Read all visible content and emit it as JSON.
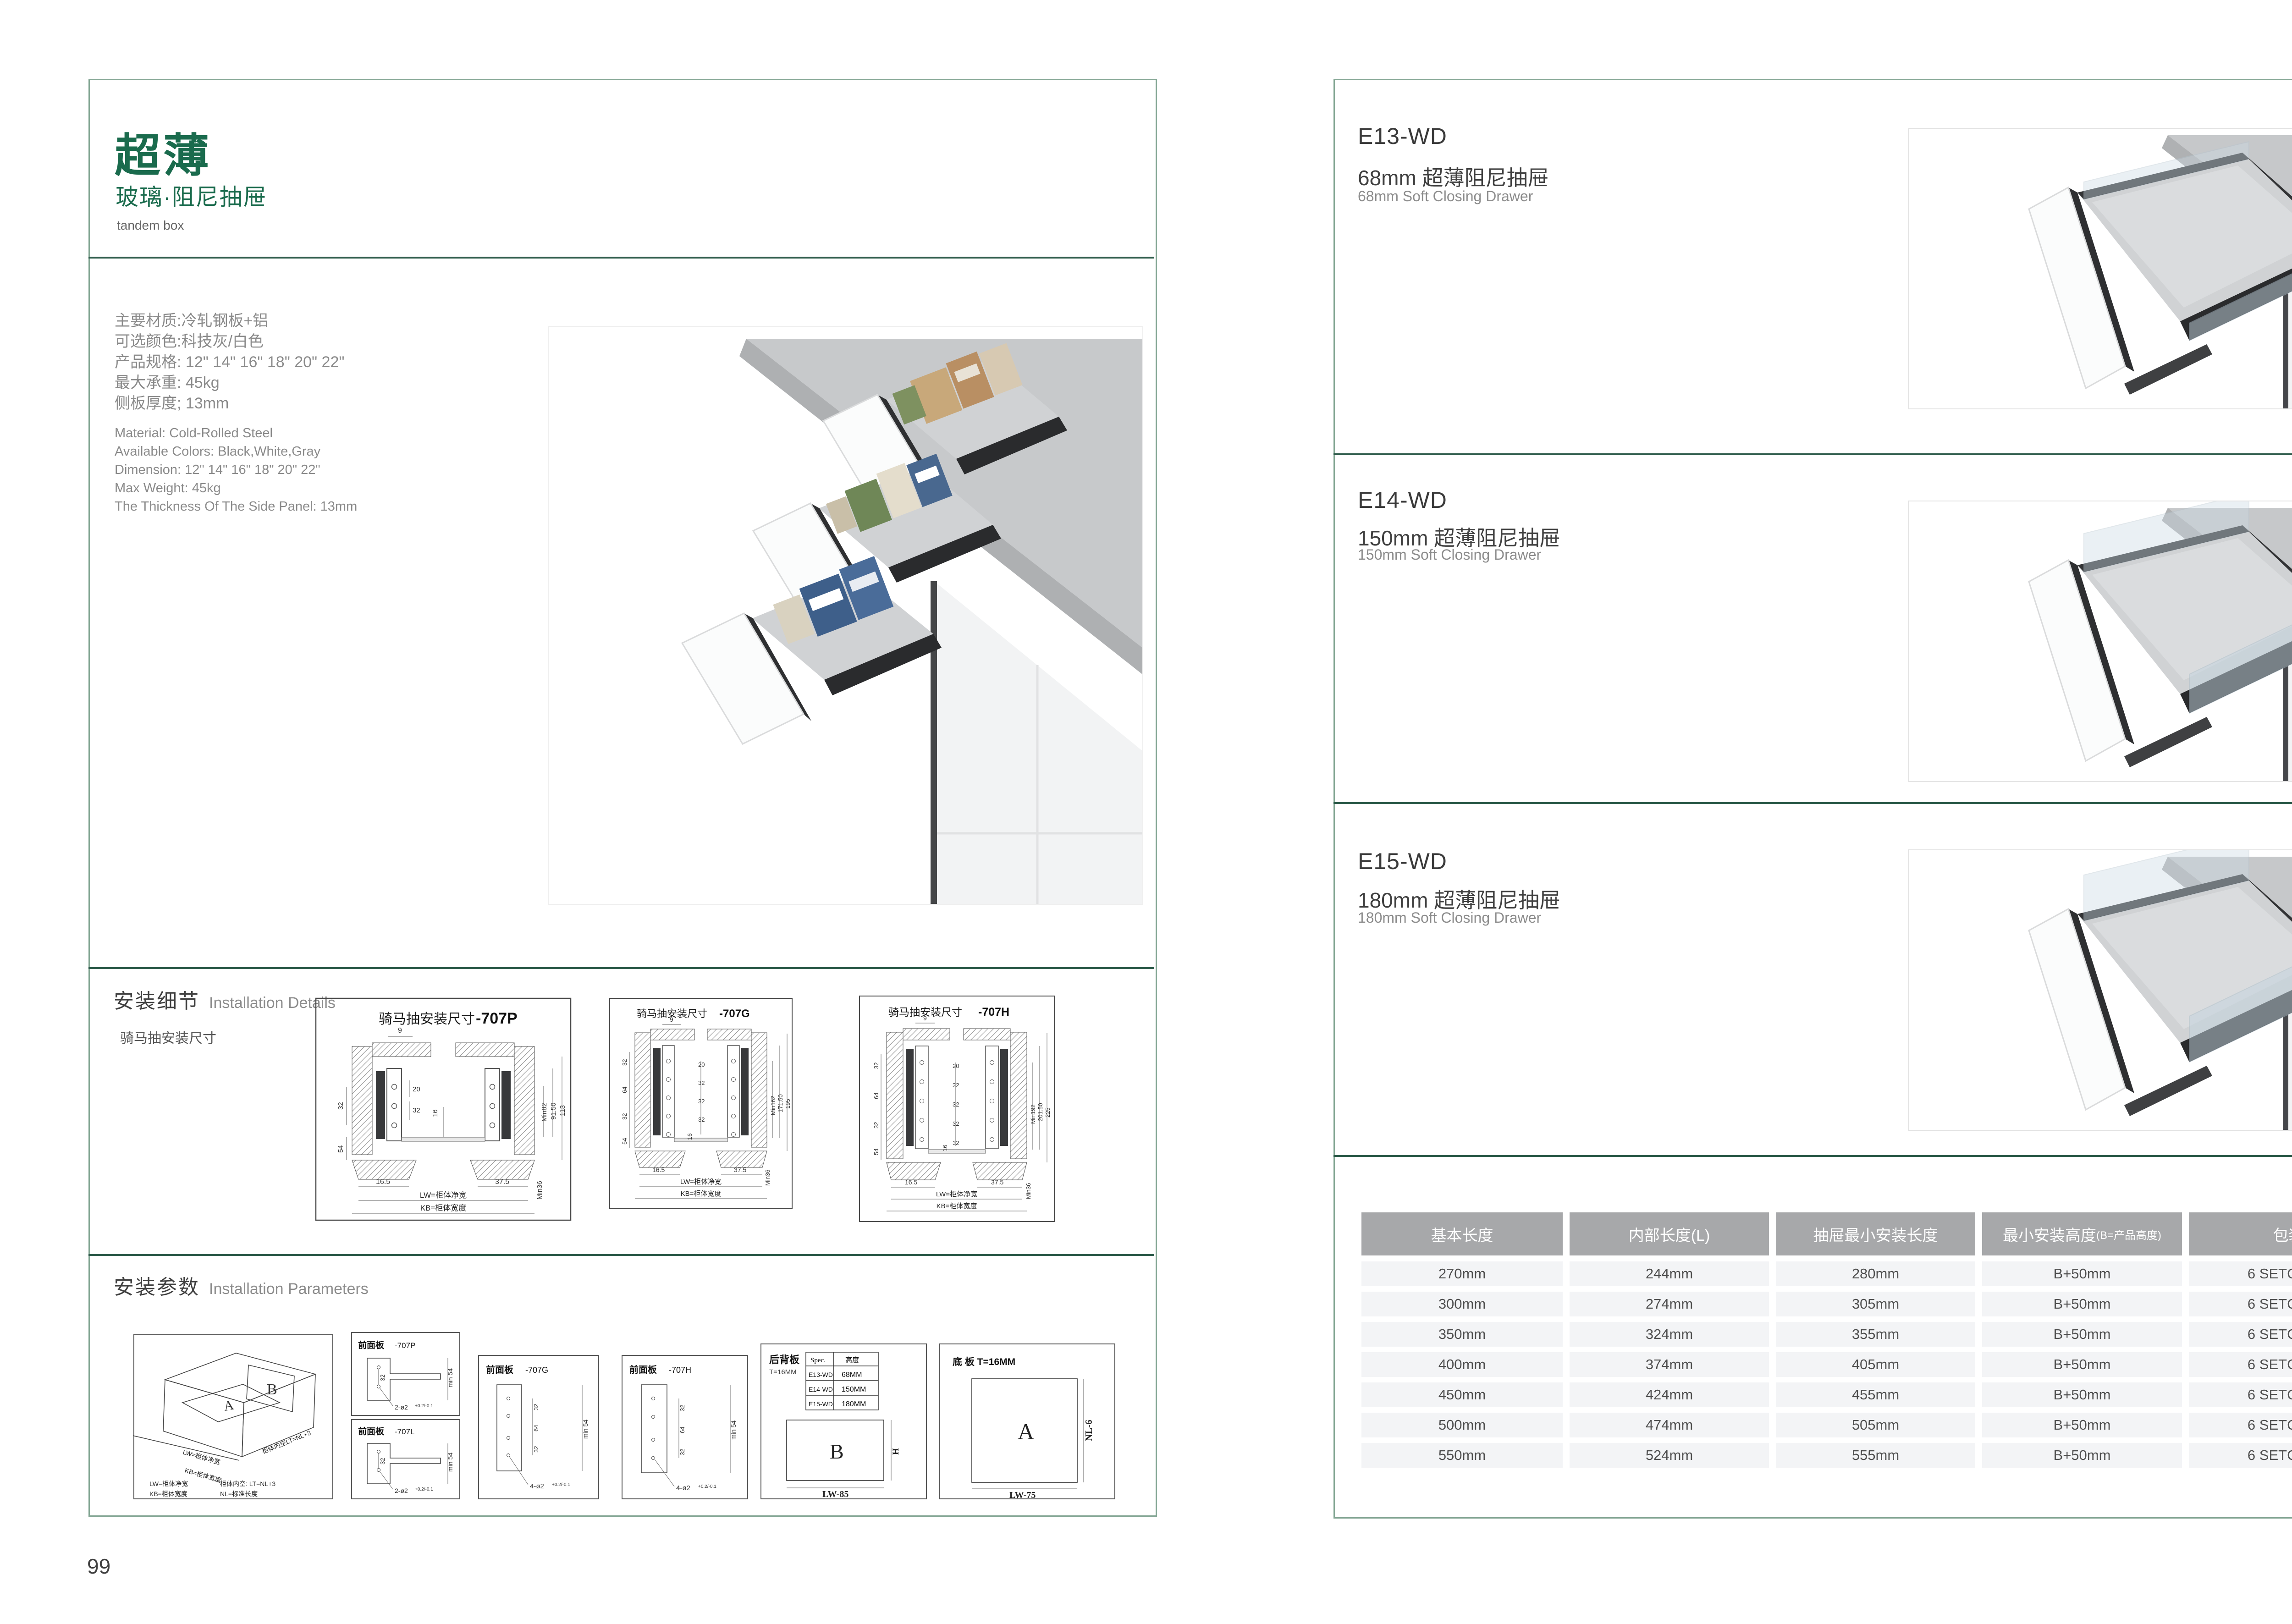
{
  "colors": {
    "accent_green": "#1a6b4d",
    "page_border": "#85a795",
    "divider_green": "#2e5c4b",
    "table_header_bg": "#a7a8aa",
    "table_row_bg": "#f3f4f6"
  },
  "pages": {
    "left": {
      "page_number": "99",
      "header": {
        "title": "超薄",
        "subtitle": "玻璃·阻尼抽屉",
        "tag": "tandem box"
      },
      "specs_cn": [
        "主要材质:冷轧钢板+铝",
        "可选颜色:科技灰/白色",
        "产品规格: 12\" 14\" 16\" 18\" 20\" 22\"",
        "最大承重: 45kg",
        "侧板厚度; 13mm"
      ],
      "specs_en": [
        "Material: Cold-Rolled Steel",
        "Available Colors: Black,White,Gray",
        "Dimension: 12\" 14\" 16\" 18\" 20\" 22\"",
        "Max Weight: 45kg",
        "The Thickness Of The Side Panel: 13mm"
      ],
      "sections": {
        "details_cn": "安装细节",
        "details_en": "Installation Details",
        "details_sub": "骑马抽安装尺寸",
        "params_cn": "安装参数",
        "params_en": "Installation Parameters"
      },
      "drawings": [
        {
          "title": "骑马抽安装尺寸",
          "code": "-707P",
          "top": "9",
          "inner": [
            "20",
            "32"
          ],
          "center": "16",
          "left": [
            "32",
            "54"
          ],
          "right": [
            "Min82",
            "91.50",
            "113"
          ],
          "bottom": [
            "16.5",
            "37.5",
            "Min36"
          ],
          "lw": "LW=柜体净宽",
          "kb": "KB=柜体宽度"
        },
        {
          "title": "骑马抽安装尺寸",
          "code": "-707G",
          "top": "9",
          "inner": [
            "20",
            "32",
            "32",
            "32"
          ],
          "center": "16",
          "left": [
            "32",
            "64",
            "32",
            "54"
          ],
          "right": [
            "Min162",
            "171.50",
            "195"
          ],
          "bottom": [
            "16.5",
            "37.5",
            "Min36"
          ],
          "lw": "LW=柜体净宽",
          "kb": "KB=柜体宽度"
        },
        {
          "title": "骑马抽安装尺寸",
          "code": "-707H",
          "top": "9",
          "inner": [
            "20",
            "32",
            "32",
            "32",
            "32"
          ],
          "center": "16",
          "left": [
            "32",
            "64",
            "32",
            "54"
          ],
          "right": [
            "Min192",
            "201.50",
            "225"
          ],
          "bottom": [
            "16.5",
            "37.5",
            "Min36"
          ],
          "lw": "LW=柜体净宽",
          "kb": "KB=柜体宽度"
        }
      ],
      "iso": {
        "label_a": "A",
        "label_b": "B",
        "edge_lw": "LW=柜体净宽",
        "edge_kb": "KB=柜体宽度",
        "edge_lt": "柜体内空LT=NL+3",
        "legend1": "LW=柜体净宽",
        "legend2": "柜体内空: LT=NL+3",
        "legend3": "KB=柜体宽度",
        "legend4": "NL=标准长度"
      },
      "panels": [
        {
          "title": "前面板",
          "code": "-707P",
          "d1": "32",
          "min": "min 54",
          "holes": "2-ø2",
          "tol": "+0.2/-0.1"
        },
        {
          "title": "前面板",
          "code": "-707L",
          "d1": "32",
          "min": "min 54",
          "holes": "2-ø2",
          "tol": "+0.2/-0.1"
        },
        {
          "title": "前面板",
          "code": "-707G",
          "d1": "32",
          "d2": "64",
          "d3": "32",
          "min": "min 54",
          "holes": "4-ø2",
          "tol": "+0.2/-0.1"
        },
        {
          "title": "前面板",
          "code": "-707H",
          "d1": "32",
          "d2": "64",
          "d3": "32",
          "min": "min 54",
          "holes": "4-ø2",
          "tol": "+0.2/-0.1"
        }
      ],
      "back_panel": {
        "title": "后背板",
        "t": "T=16MM",
        "spec_h1": "Spec.",
        "spec_h2": "高度",
        "spec_rows": [
          [
            "E13-WD",
            "68MM"
          ],
          [
            "E14-WD",
            "150MM"
          ],
          [
            "E15-WD",
            "180MM"
          ]
        ],
        "label": "B",
        "h": "H",
        "lw": "LW-85"
      },
      "bottom_panel": {
        "title": "底 板 T=16MM",
        "label": "A",
        "nl": "NL-6",
        "lw": "LW-75"
      }
    },
    "right": {
      "page_number": "100",
      "products": [
        {
          "code": "E13-WD",
          "name_cn": "68mm 超薄阻尼抽屉",
          "name_en": "68mm Soft Closing Drawer"
        },
        {
          "code": "E14-WD",
          "name_cn": "150mm 超薄阻尼抽屉",
          "name_en": "150mm Soft Closing Drawer"
        },
        {
          "code": "E15-WD",
          "name_cn": "180mm 超薄阻尼抽屉",
          "name_en": "180mm Soft Closing Drawer"
        }
      ],
      "table": {
        "headers": [
          "基本长度",
          "内部长度(L)",
          "抽屉最小安装长度",
          "最小安装高度",
          "包装"
        ],
        "header4_sub": "(B=产品高度)",
        "rows": [
          [
            "270mm",
            "244mm",
            "280mm",
            "B+50mm",
            "6 SETC/TNB"
          ],
          [
            "300mm",
            "274mm",
            "305mm",
            "B+50mm",
            "6 SETC/TNB"
          ],
          [
            "350mm",
            "324mm",
            "355mm",
            "B+50mm",
            "6 SETC/TNB"
          ],
          [
            "400mm",
            "374mm",
            "405mm",
            "B+50mm",
            "6 SETC/TNB"
          ],
          [
            "450mm",
            "424mm",
            "455mm",
            "B+50mm",
            "6 SETC/TNB"
          ],
          [
            "500mm",
            "474mm",
            "505mm",
            "B+50mm",
            "6 SETC/TNB"
          ],
          [
            "550mm",
            "524mm",
            "555mm",
            "B+50mm",
            "6 SETC/TNB"
          ]
        ]
      }
    }
  }
}
